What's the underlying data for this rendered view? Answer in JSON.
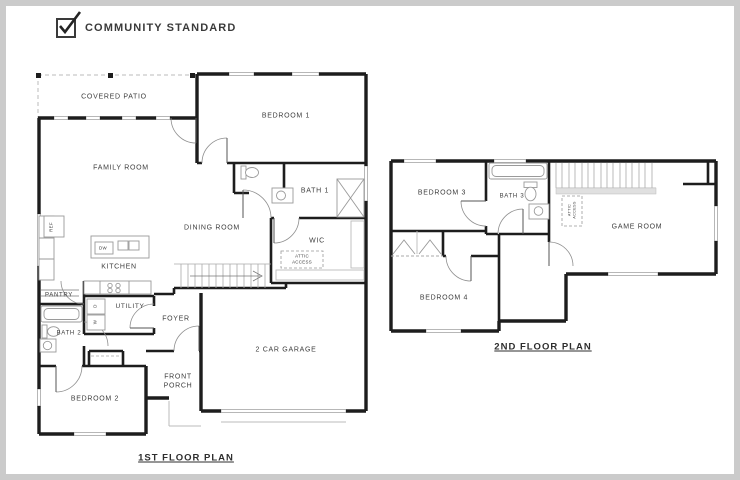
{
  "header": {
    "option_label": "COMMUNITY STANDARD",
    "checked": true
  },
  "first_floor": {
    "title": "1ST FLOOR PLAN",
    "labels": {
      "covered_patio": "COVERED PATIO",
      "family_room": "FAMILY ROOM",
      "bedroom_1": "BEDROOM 1",
      "bath_1": "BATH 1",
      "dining_room": "DINING ROOM",
      "wic": "WIC",
      "attic_access": "ATTIC ACCESS",
      "kitchen": "KITCHEN",
      "pantry": "PANTRY",
      "utility": "UTILITY",
      "bath_2": "BATH 2",
      "foyer": "FOYER",
      "front_porch": "FRONT PORCH",
      "bedroom_2": "BEDROOM 2",
      "garage": "2 CAR GARAGE",
      "ref": "REF",
      "dw": "DW",
      "washer": "W",
      "dryer": "D"
    }
  },
  "second_floor": {
    "title": "2ND FLOOR PLAN",
    "labels": {
      "bedroom_3": "BEDROOM 3",
      "bath_3": "BATH 3",
      "game_room": "GAME ROOM",
      "bedroom_4": "BEDROOM 4",
      "attic_access": "ATTIC ACCESS"
    }
  },
  "colors": {
    "wall": "#1d1d1d",
    "window_line": "#999999",
    "fixture_line": "#9a9a9a",
    "patio_line": "#bbbbbb",
    "text": "#3d3d3d",
    "frame": "#cbcbcb"
  }
}
